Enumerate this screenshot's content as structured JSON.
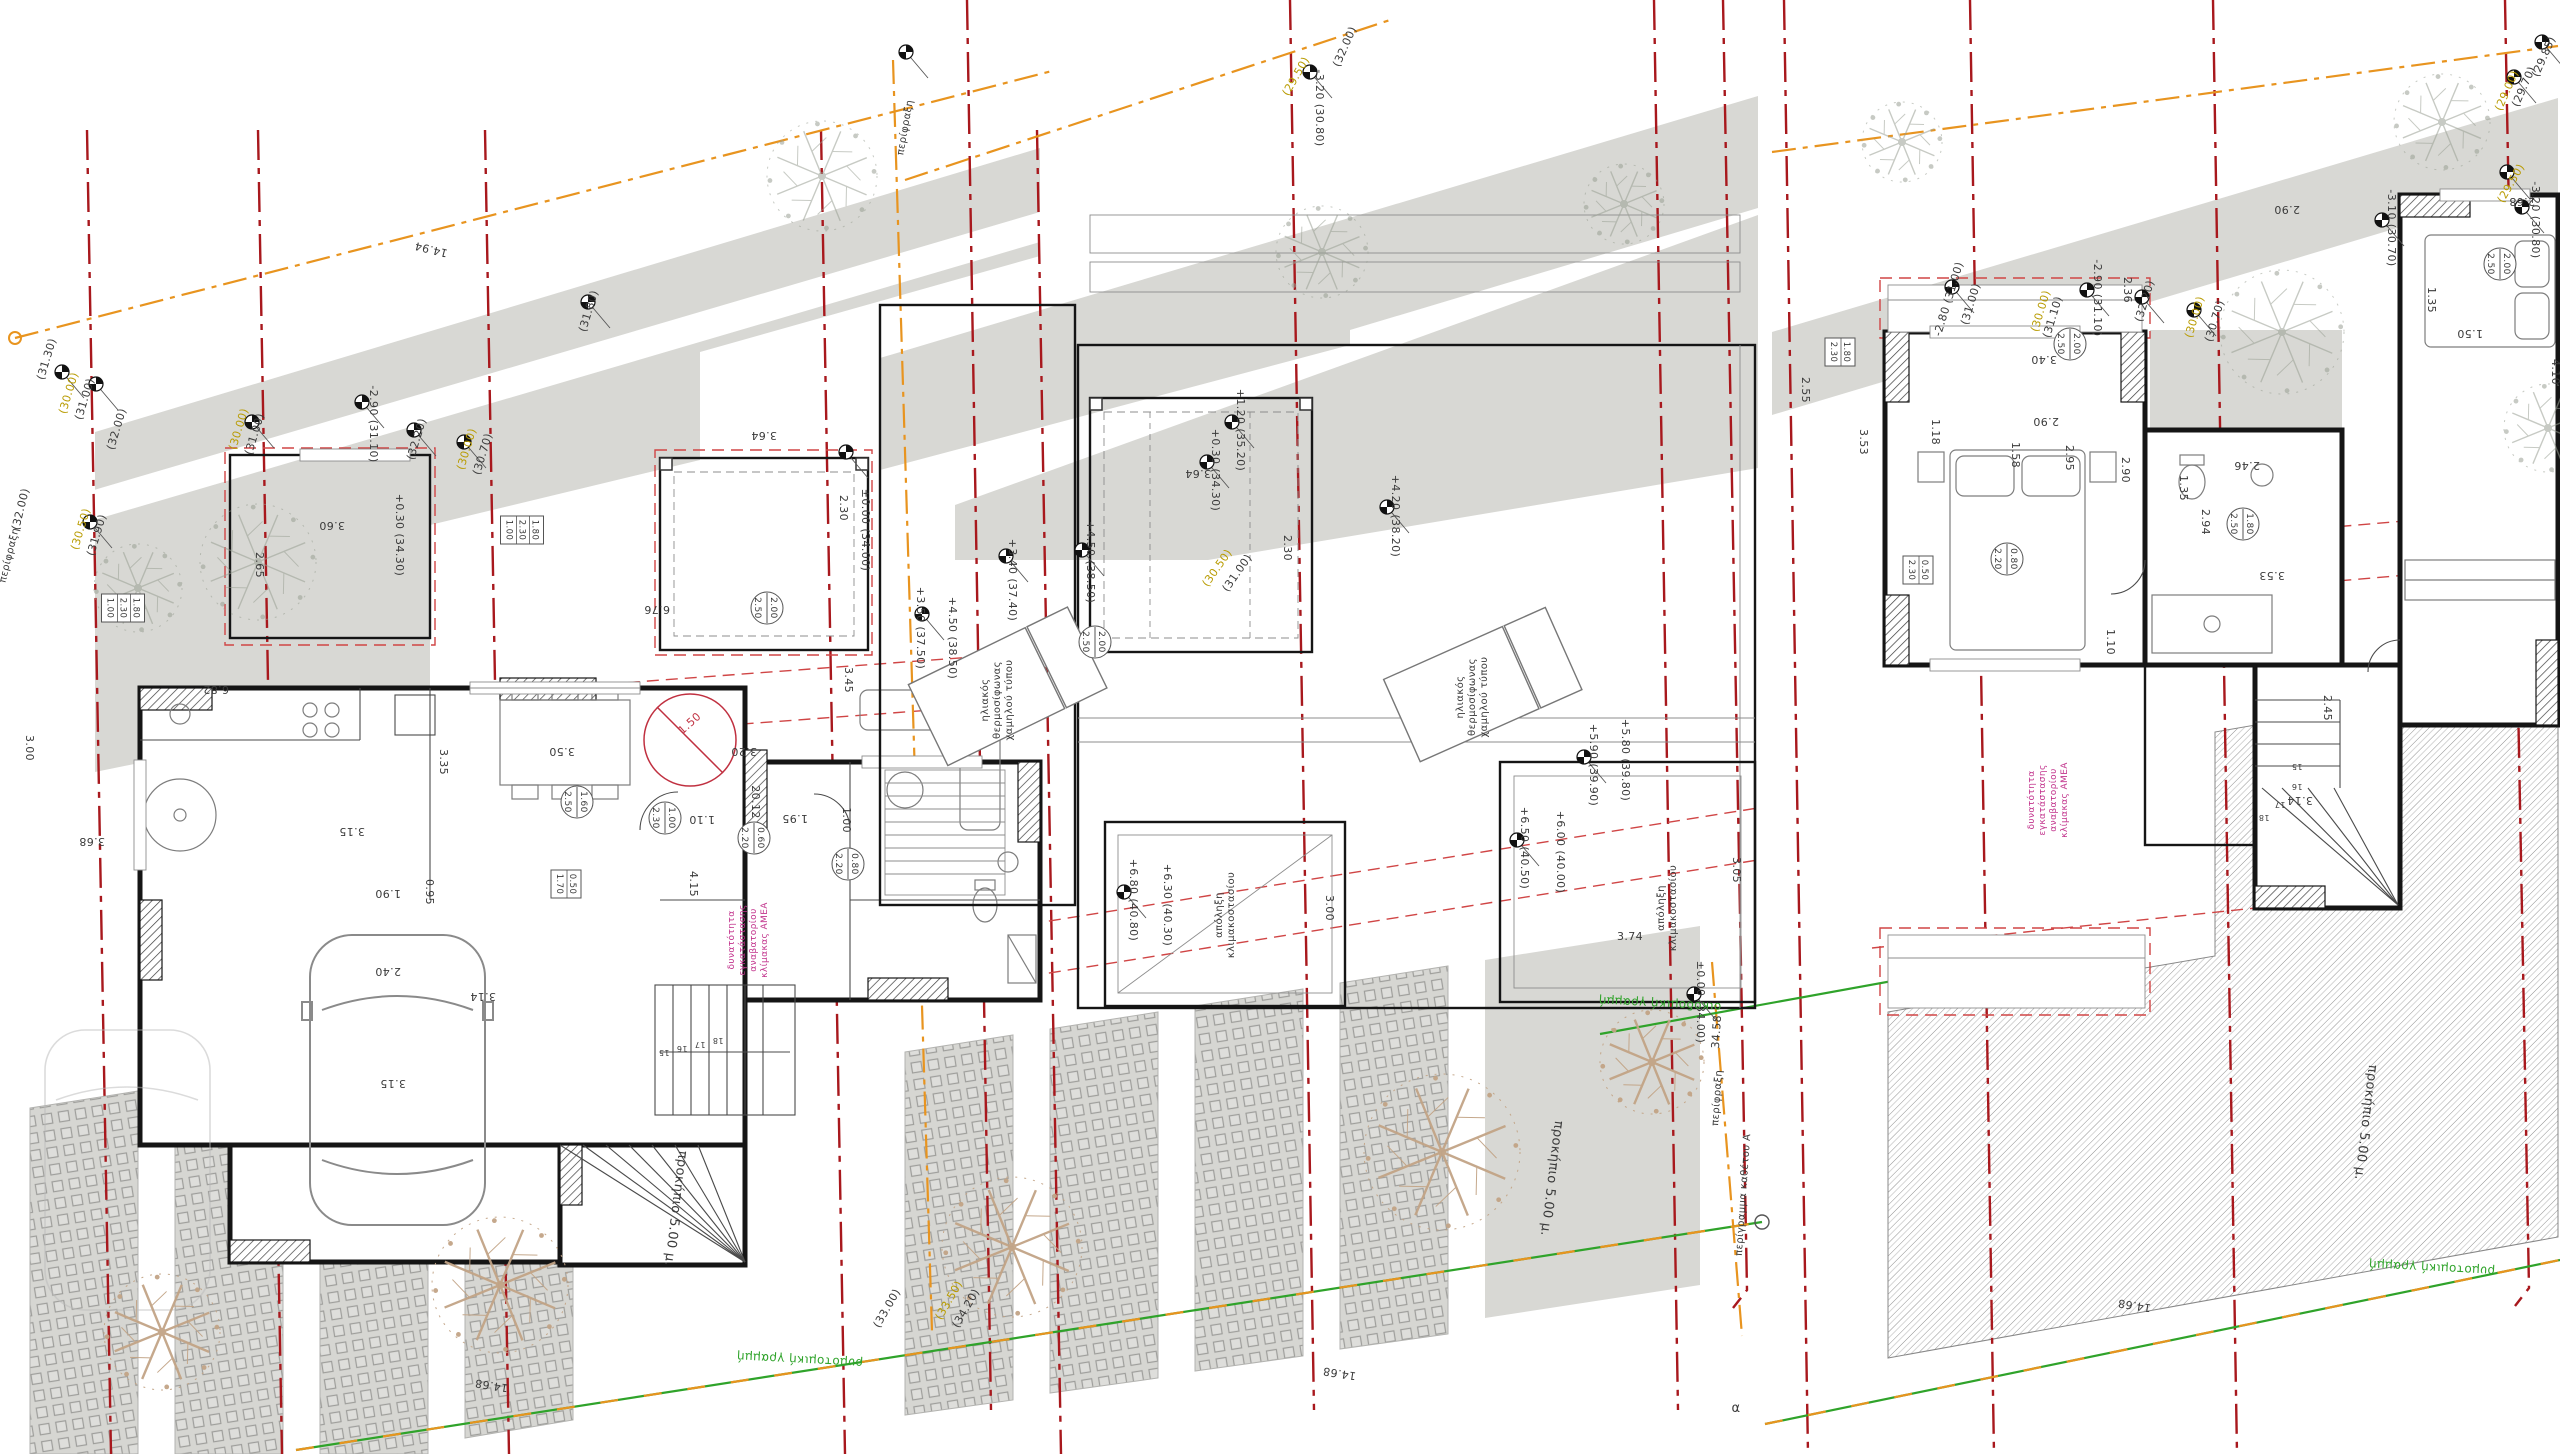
{
  "sheet": {
    "description": "Greek architectural drawing sheet with three adjacent plans (ground floor with parking and garden, roof plan with solar water heaters and stair exits, upper floor with bedrooms and large hatched terrace), property boundary lines, grid axes and spot elevations",
    "language": "el"
  },
  "colors": {
    "grid_red": "#a8181d",
    "dash_red": "#d04545",
    "fence_orange": "#e8941f",
    "street_green": "#2fa32a",
    "elev_yellow": "#b89b00",
    "note_magenta": "#c2338c",
    "accent_red": "#c03040",
    "area_gray": "#d8d8d4",
    "wall_black": "#151515",
    "dim_text": "#3a3a3a",
    "tree_tan": "#c2a486",
    "tree_gray": "#9aa094"
  },
  "annotations": [
    {
      "t": "14.94",
      "x": 432,
      "y": 246,
      "r": 194
    },
    {
      "t": "(31.30)",
      "x": 50,
      "y": 360,
      "r": -73
    },
    {
      "t": "(30.00)",
      "x": 72,
      "y": 394,
      "r": -73,
      "c": "y"
    },
    {
      "t": "(31.00)",
      "x": 88,
      "y": 400,
      "r": -73
    },
    {
      "t": "(32.00)",
      "x": 120,
      "y": 430,
      "r": -73
    },
    {
      "t": "(30.00)",
      "x": 242,
      "y": 430,
      "r": -73,
      "c": "y"
    },
    {
      "t": "(31.00)",
      "x": 258,
      "y": 435,
      "r": -73
    },
    {
      "t": "(32.00)",
      "x": 24,
      "y": 510,
      "r": -76
    },
    {
      "t": "περίφραξη",
      "x": 12,
      "y": 556,
      "r": -76,
      "s": 10
    },
    {
      "t": "(30.50)",
      "x": 84,
      "y": 530,
      "r": -73,
      "c": "y"
    },
    {
      "t": "(31.90)",
      "x": 100,
      "y": 536,
      "r": -73
    },
    {
      "t": "-2.90 (31.10)",
      "x": 370,
      "y": 424,
      "r": 90
    },
    {
      "t": "(32.20)",
      "x": 420,
      "y": 440,
      "r": -73
    },
    {
      "t": "(30.00)",
      "x": 470,
      "y": 450,
      "r": -73,
      "c": "y"
    },
    {
      "t": "(30.70)",
      "x": 486,
      "y": 455,
      "r": -73
    },
    {
      "t": "(31.80)",
      "x": 592,
      "y": 312,
      "r": -73
    },
    {
      "t": "3.60",
      "x": 332,
      "y": 522
    },
    {
      "t": "2.65",
      "x": 256,
      "y": 565,
      "r": 90
    },
    {
      "t": "+0.30 (34.30)",
      "x": 396,
      "y": 535,
      "r": 90
    },
    {
      "t": "3.64",
      "x": 764,
      "y": 432
    },
    {
      "t": "2.30",
      "x": 840,
      "y": 508,
      "r": 90
    },
    {
      "t": "±0.00 (34.00)",
      "x": 862,
      "y": 530,
      "r": 90
    },
    {
      "t": "6.76",
      "x": 657,
      "y": 606
    },
    {
      "t": "6.82",
      "x": 216,
      "y": 686
    },
    {
      "t": "3.45",
      "x": 845,
      "y": 680,
      "r": 90
    },
    {
      "t": "3.35",
      "x": 440,
      "y": 762,
      "r": 90
    },
    {
      "t": "3.50",
      "x": 562,
      "y": 748
    },
    {
      "t": "3.20",
      "x": 744,
      "y": 748
    },
    {
      "t": "1.50",
      "x": 692,
      "y": 726,
      "r": -42,
      "c": "r"
    },
    {
      "t": "3.00",
      "x": 26,
      "y": 748,
      "r": 90
    },
    {
      "t": "3.68",
      "x": 92,
      "y": 838
    },
    {
      "t": "3.15",
      "x": 352,
      "y": 828
    },
    {
      "t": "1.10",
      "x": 702,
      "y": 816
    },
    {
      "t": "1.95",
      "x": 795,
      "y": 815
    },
    {
      "t": "1.00",
      "x": 843,
      "y": 820,
      "r": 90
    },
    {
      "t": "1.90",
      "x": 388,
      "y": 890
    },
    {
      "t": "0.95",
      "x": 426,
      "y": 892,
      "r": 90
    },
    {
      "t": "4.15",
      "x": 690,
      "y": 884,
      "r": 90
    },
    {
      "t": "2.40",
      "x": 388,
      "y": 968
    },
    {
      "t": "3.14",
      "x": 483,
      "y": 993
    },
    {
      "t": "3.15",
      "x": 393,
      "y": 1080
    },
    {
      "t": "20.12",
      "x": 752,
      "y": 802,
      "r": 90
    },
    {
      "t": "14.68",
      "x": 492,
      "y": 1382,
      "r": 189
    },
    {
      "t": "προκήπιο 5.00 μ.",
      "x": 672,
      "y": 1208,
      "r": 97,
      "s": 13
    },
    {
      "t": "ρυμοτομική γραμμή",
      "x": 800,
      "y": 1356,
      "r": 183,
      "c": "g",
      "s": 12
    },
    {
      "t": "15",
      "x": 664,
      "y": 1050,
      "s": 8
    },
    {
      "t": "16",
      "x": 682,
      "y": 1046,
      "s": 8
    },
    {
      "t": "17",
      "x": 700,
      "y": 1042,
      "s": 8
    },
    {
      "t": "18",
      "x": 718,
      "y": 1038,
      "s": 8
    },
    {
      "t": "περίφραξη",
      "x": 908,
      "y": 128,
      "r": -80,
      "s": 10
    },
    {
      "t": "(29.50)",
      "x": 1299,
      "y": 78,
      "r": -60,
      "c": "y"
    },
    {
      "t": "-3.20 (30.80)",
      "x": 1316,
      "y": 108,
      "r": 90
    },
    {
      "t": "(32.00)",
      "x": 1348,
      "y": 48,
      "r": -66
    },
    {
      "t": "+1.20 (35.20)",
      "x": 1237,
      "y": 430,
      "r": 90
    },
    {
      "t": "+0.30 (34.30)",
      "x": 1212,
      "y": 470,
      "r": 90
    },
    {
      "t": "+4.20 (38.20)",
      "x": 1392,
      "y": 516,
      "r": 90
    },
    {
      "t": "(30.50)",
      "x": 1220,
      "y": 570,
      "r": -55,
      "c": "y"
    },
    {
      "t": "(31.00)",
      "x": 1240,
      "y": 575,
      "r": -55
    },
    {
      "t": "+3.40 (37.40)",
      "x": 1009,
      "y": 580,
      "r": 90
    },
    {
      "t": "+4.50 (38.50)",
      "x": 1087,
      "y": 562,
      "r": 90
    },
    {
      "t": "+3.50 (37.50)",
      "x": 917,
      "y": 628,
      "r": 90
    },
    {
      "t": "+4.50 (38.50)",
      "x": 949,
      "y": 638,
      "r": 90
    },
    {
      "t": "3.64",
      "x": 1198,
      "y": 470
    },
    {
      "t": "2.30",
      "x": 1284,
      "y": 548,
      "r": 90
    },
    {
      "t": "+6.80 (40.80)",
      "x": 1130,
      "y": 900,
      "r": 90
    },
    {
      "t": "+6.30 (40.30)",
      "x": 1164,
      "y": 905,
      "r": 90
    },
    {
      "t": "3.00",
      "x": 1326,
      "y": 908,
      "r": 90
    },
    {
      "t": "+6.50 (40.50)",
      "x": 1521,
      "y": 848,
      "r": 90
    },
    {
      "t": "+6.00 (40.00)",
      "x": 1557,
      "y": 852,
      "r": 90
    },
    {
      "t": "+5.90 (39.90)",
      "x": 1590,
      "y": 765,
      "r": 90
    },
    {
      "t": "+5.80 (39.80)",
      "x": 1622,
      "y": 760,
      "r": 90
    },
    {
      "t": "3.74",
      "x": 1630,
      "y": 940,
      "r": 0
    },
    {
      "t": "3.05",
      "x": 1733,
      "y": 870,
      "r": 90
    },
    {
      "t": "±0.00 (34.00)",
      "x": 1697,
      "y": 1002,
      "r": 90
    },
    {
      "t": "(33.00)",
      "x": 890,
      "y": 1310,
      "r": -60
    },
    {
      "t": "(33.50)",
      "x": 952,
      "y": 1302,
      "r": -60,
      "c": "y"
    },
    {
      "t": "(34.20)",
      "x": 969,
      "y": 1310,
      "r": -60
    },
    {
      "t": "προκήπιο 5.00 μ.",
      "x": 1548,
      "y": 1178,
      "r": 97,
      "s": 13
    },
    {
      "t": "οικοδομική γραμμή",
      "x": 1660,
      "y": 1000,
      "r": 183,
      "c": "g",
      "s": 12
    },
    {
      "t": "34.58",
      "x": 1720,
      "y": 1032,
      "r": -86
    },
    {
      "t": "περίφραξη",
      "x": 1720,
      "y": 1098,
      "r": -86,
      "s": 10
    },
    {
      "t": "περίγραμμα καθέτου Α",
      "x": 1746,
      "y": 1195,
      "r": -86,
      "s": 10
    },
    {
      "t": "14.68",
      "x": 1340,
      "y": 1370,
      "r": 189
    },
    {
      "t": "α",
      "x": 1736,
      "y": 1412,
      "r": 0,
      "s": 13
    },
    {
      "t": "(29.85)",
      "x": 2547,
      "y": 58,
      "r": -66
    },
    {
      "t": "(29.70)",
      "x": 2527,
      "y": 88,
      "r": -66
    },
    {
      "t": "(29.00)",
      "x": 2510,
      "y": 92,
      "r": -66,
      "c": "y"
    },
    {
      "t": "(29.50)",
      "x": 2514,
      "y": 185,
      "r": -60,
      "c": "y"
    },
    {
      "t": "-3.20 (30.80)",
      "x": 2532,
      "y": 220,
      "r": 90
    },
    {
      "t": "-3.10 (30.70)",
      "x": 2388,
      "y": 228,
      "r": 90
    },
    {
      "t": "-2.80 (31.00)",
      "x": 1952,
      "y": 300,
      "r": -73
    },
    {
      "t": "(31.00)",
      "x": 1974,
      "y": 305,
      "r": -73
    },
    {
      "t": "(30.00)",
      "x": 2044,
      "y": 312,
      "r": -73,
      "c": "y"
    },
    {
      "t": "(31.10)",
      "x": 2056,
      "y": 318,
      "r": -73
    },
    {
      "t": "-2.90 (31.10)",
      "x": 2094,
      "y": 298,
      "r": 90
    },
    {
      "t": "2.36",
      "x": 2124,
      "y": 290,
      "r": 90
    },
    {
      "t": "(32.20)",
      "x": 2148,
      "y": 302,
      "r": -73
    },
    {
      "t": "(30.00)",
      "x": 2198,
      "y": 318,
      "r": -73,
      "c": "y"
    },
    {
      "t": "(30.70)",
      "x": 2218,
      "y": 322,
      "r": -73
    },
    {
      "t": "2.90",
      "x": 2287,
      "y": 206
    },
    {
      "t": "3.40",
      "x": 2044,
      "y": 356
    },
    {
      "t": "2.90",
      "x": 2046,
      "y": 418
    },
    {
      "t": "2.90",
      "x": 2122,
      "y": 470,
      "r": 90
    },
    {
      "t": "1.35",
      "x": 2180,
      "y": 488,
      "r": 90
    },
    {
      "t": "2.46",
      "x": 2247,
      "y": 462
    },
    {
      "t": "3.53",
      "x": 2272,
      "y": 572
    },
    {
      "t": "2.55",
      "x": 1802,
      "y": 390,
      "r": 90
    },
    {
      "t": "3.53",
      "x": 1860,
      "y": 442,
      "r": 90
    },
    {
      "t": "1.18",
      "x": 1932,
      "y": 432,
      "r": 90
    },
    {
      "t": "1.58",
      "x": 2012,
      "y": 455,
      "r": 90
    },
    {
      "t": "2.95",
      "x": 2066,
      "y": 458,
      "r": 90
    },
    {
      "t": "2.94",
      "x": 2202,
      "y": 522,
      "r": 90
    },
    {
      "t": "1.10",
      "x": 2107,
      "y": 642,
      "r": 90
    },
    {
      "t": "2.68",
      "x": 2522,
      "y": 198
    },
    {
      "t": "1.35",
      "x": 2428,
      "y": 300,
      "r": 90
    },
    {
      "t": "1.50",
      "x": 2470,
      "y": 330
    },
    {
      "t": "2.45",
      "x": 2324,
      "y": 708,
      "r": 90
    },
    {
      "t": "3.14",
      "x": 2300,
      "y": 797
    },
    {
      "t": "4.10",
      "x": 2552,
      "y": 372,
      "r": 90
    },
    {
      "t": "15",
      "x": 2297,
      "y": 764,
      "s": 8
    },
    {
      "t": "16",
      "x": 2297,
      "y": 784,
      "s": 8
    },
    {
      "t": "17",
      "x": 2280,
      "y": 802,
      "s": 8
    },
    {
      "t": "18",
      "x": 2264,
      "y": 815,
      "s": 8
    },
    {
      "t": "14.68",
      "x": 2135,
      "y": 1302,
      "r": 189
    },
    {
      "t": "προκήπιο 5.00 μ.",
      "x": 2362,
      "y": 1122,
      "r": 97,
      "s": 13
    },
    {
      "t": "ρυμοτομική γραμμή",
      "x": 2432,
      "y": 1264,
      "r": 183,
      "c": "g",
      "s": 12
    }
  ],
  "window_specs": [
    {
      "x": 767,
      "y": 608,
      "r": 90,
      "top": "2.00",
      "bot": "2.50"
    },
    {
      "x": 577,
      "y": 802,
      "r": 90,
      "top": "1.60",
      "bot": "2.50"
    },
    {
      "x": 665,
      "y": 818,
      "r": 90,
      "top": "1.00",
      "bot": "2.30"
    },
    {
      "x": 754,
      "y": 838,
      "r": 90,
      "top": "0.60",
      "bot": "2.20"
    },
    {
      "x": 848,
      "y": 864,
      "r": 90,
      "top": "0.80",
      "bot": "2.20"
    },
    {
      "x": 1095,
      "y": 642,
      "r": 90,
      "top": "2.00",
      "bot": "2.50"
    },
    {
      "x": 2500,
      "y": 264,
      "r": 90,
      "top": "2.00",
      "bot": "2.50"
    },
    {
      "x": 2070,
      "y": 344,
      "r": 90,
      "top": "2.00",
      "bot": "2.50"
    },
    {
      "x": 2243,
      "y": 524,
      "r": 90,
      "top": "1.80",
      "bot": "2.50"
    },
    {
      "x": 2007,
      "y": 559,
      "r": 90,
      "top": "0.80",
      "bot": "2.20"
    }
  ],
  "door_specs": [
    {
      "x": 522,
      "y": 530,
      "lines": [
        "1.80",
        "2.30",
        "1.00"
      ]
    },
    {
      "x": 123,
      "y": 608,
      "lines": [
        "1.80",
        "2.30",
        "1.00"
      ]
    },
    {
      "x": 566,
      "y": 884,
      "lines": [
        "0.50",
        "1.70"
      ]
    },
    {
      "x": 1918,
      "y": 570,
      "lines": [
        "0.50",
        "2.30"
      ]
    },
    {
      "x": 1840,
      "y": 352,
      "lines": [
        "1.80",
        "2.30"
      ]
    }
  ],
  "notes": [
    {
      "lines": [
        "δυνατότητα",
        "εγκατάστασης",
        "αναβατορίου",
        "κλίμακας ΑΜΕΑ"
      ],
      "x": 734,
      "y": 940,
      "s": 9,
      "c": "m"
    },
    {
      "lines": [
        "δυνατότητα",
        "εγκατάστασης",
        "αναβατορίου",
        "κλίμακας ΑΜΕΑ"
      ],
      "x": 2034,
      "y": 800,
      "s": 9,
      "c": "m"
    },
    {
      "lines": [
        "ηλιακός",
        "θερμοσίφωνας",
        "χαμηλού τύπου"
      ],
      "x": 988,
      "y": 700,
      "s": 10,
      "c": "k"
    },
    {
      "lines": [
        "ηλιακός",
        "θερμοσίφωνας",
        "χαμηλού τύπου"
      ],
      "x": 1463,
      "y": 697,
      "s": 10,
      "c": "k"
    },
    {
      "lines": [
        "απόληξη",
        "κλιμακοστασίου"
      ],
      "x": 1222,
      "y": 915,
      "s": 10,
      "c": "k"
    },
    {
      "lines": [
        "απόληξη",
        "κλιμακοστασίου"
      ],
      "x": 1664,
      "y": 908,
      "s": 10,
      "c": "k"
    }
  ],
  "spot_markers": [
    {
      "x": 62,
      "y": 372
    },
    {
      "x": 96,
      "y": 384
    },
    {
      "x": 252,
      "y": 422
    },
    {
      "x": 362,
      "y": 402
    },
    {
      "x": 414,
      "y": 430
    },
    {
      "x": 464,
      "y": 442
    },
    {
      "x": 90,
      "y": 522
    },
    {
      "x": 846,
      "y": 452
    },
    {
      "x": 588,
      "y": 302
    },
    {
      "x": 906,
      "y": 52
    },
    {
      "x": 1310,
      "y": 72
    },
    {
      "x": 1006,
      "y": 556
    },
    {
      "x": 1082,
      "y": 550
    },
    {
      "x": 922,
      "y": 614
    },
    {
      "x": 1232,
      "y": 422
    },
    {
      "x": 1207,
      "y": 462
    },
    {
      "x": 1387,
      "y": 507
    },
    {
      "x": 1124,
      "y": 892
    },
    {
      "x": 1517,
      "y": 840
    },
    {
      "x": 1584,
      "y": 757
    },
    {
      "x": 1694,
      "y": 994
    },
    {
      "x": 2542,
      "y": 42
    },
    {
      "x": 2514,
      "y": 77
    },
    {
      "x": 2507,
      "y": 172
    },
    {
      "x": 2522,
      "y": 207
    },
    {
      "x": 2382,
      "y": 220
    },
    {
      "x": 1952,
      "y": 287
    },
    {
      "x": 2087,
      "y": 290
    },
    {
      "x": 2142,
      "y": 297
    },
    {
      "x": 2194,
      "y": 310
    }
  ],
  "trees": [
    {
      "x": 500,
      "y": 1285,
      "rad": 68,
      "kind": "tan"
    },
    {
      "x": 162,
      "y": 1332,
      "rad": 58,
      "kind": "tan"
    },
    {
      "x": 1012,
      "y": 1247,
      "rad": 70,
      "kind": "tan"
    },
    {
      "x": 1442,
      "y": 1152,
      "rad": 78,
      "kind": "tan"
    },
    {
      "x": 1652,
      "y": 1062,
      "rad": 52,
      "kind": "tan"
    },
    {
      "x": 822,
      "y": 176,
      "rad": 55,
      "kind": "gray"
    },
    {
      "x": 258,
      "y": 562,
      "rad": 58,
      "kind": "gray"
    },
    {
      "x": 138,
      "y": 588,
      "rad": 44,
      "kind": "gray"
    },
    {
      "x": 1322,
      "y": 252,
      "rad": 46,
      "kind": "gray"
    },
    {
      "x": 1624,
      "y": 204,
      "rad": 40,
      "kind": "gray"
    },
    {
      "x": 2282,
      "y": 332,
      "rad": 62,
      "kind": "gray"
    },
    {
      "x": 2442,
      "y": 122,
      "rad": 48,
      "kind": "gray"
    },
    {
      "x": 1902,
      "y": 142,
      "rad": 40,
      "kind": "gray"
    },
    {
      "x": 2548,
      "y": 428,
      "rad": 44,
      "kind": "gray"
    }
  ]
}
